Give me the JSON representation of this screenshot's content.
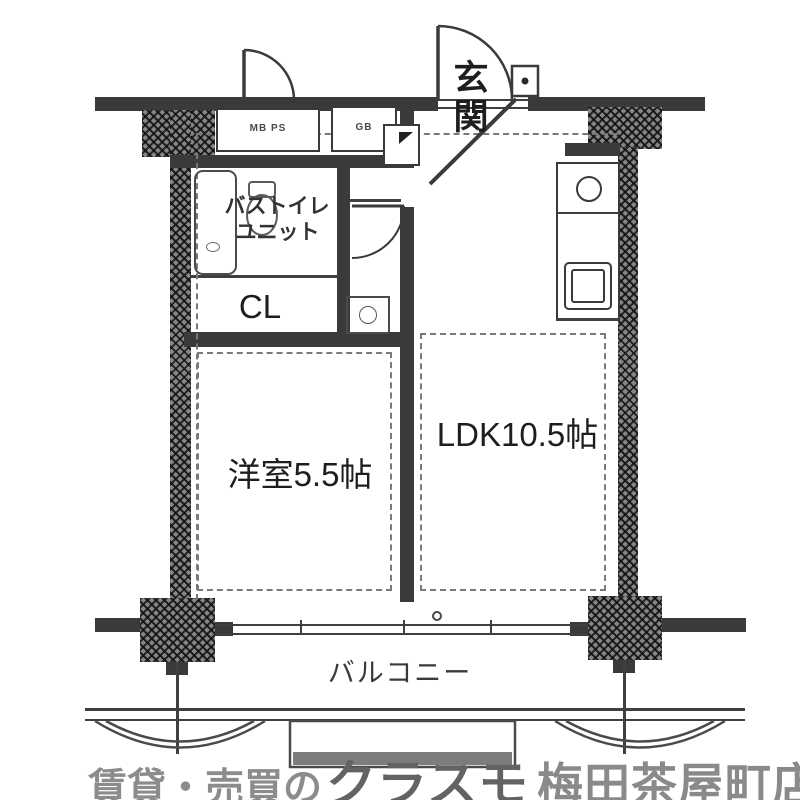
{
  "floorplan": {
    "rooms": {
      "entrance": {
        "label": "玄関"
      },
      "bath_toilet_unit": {
        "line1": "バストイレ",
        "line2": "ユニット"
      },
      "closet": {
        "label": "CL"
      },
      "western_room": {
        "label": "洋室5.5帖"
      },
      "ldk": {
        "label": "LDK10.5帖"
      },
      "balcony": {
        "label": "バルコニー"
      }
    },
    "utility_labels": {
      "meter_pipe_space": "MB PS",
      "gas_box": "GB"
    }
  },
  "branding": {
    "prefix": "賃貸・売買の",
    "logo": "クラスモ",
    "store": "梅田茶屋町店"
  },
  "colors": {
    "line": "#3a3a3a",
    "watermark": "#8c8c8c",
    "logo_gray": "#636363",
    "background": "#ffffff"
  }
}
